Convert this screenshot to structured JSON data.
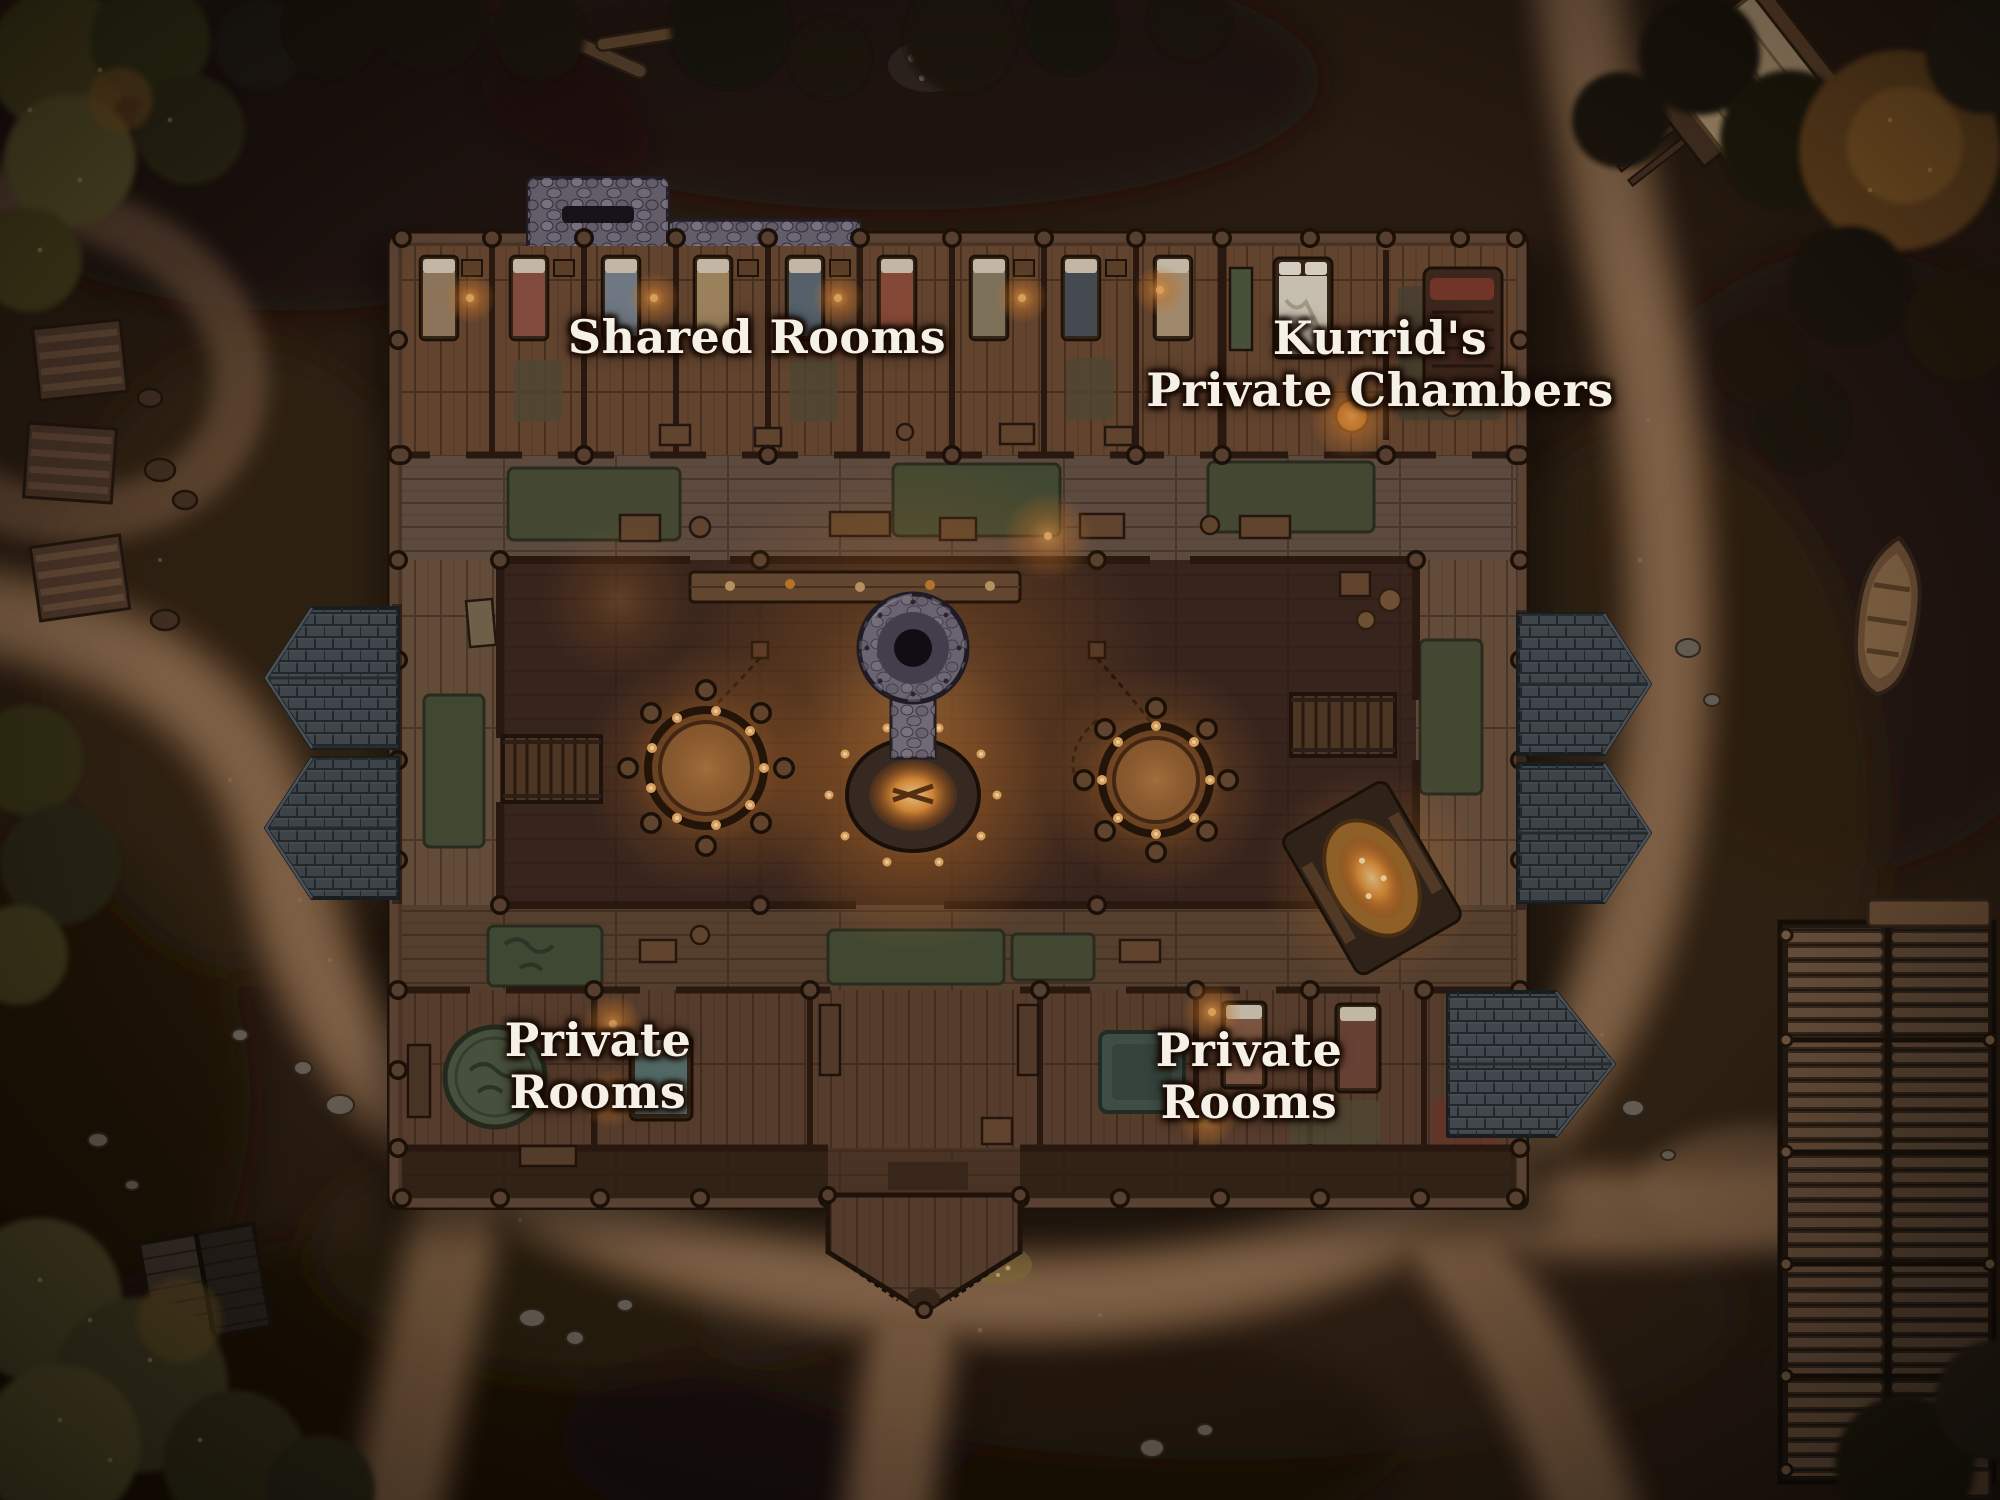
{
  "map": {
    "type": "fantasy-tavern-battle-map",
    "labels": [
      {
        "name": "shared-rooms",
        "lines": [
          "Shared Rooms"
        ],
        "x": 757,
        "y": 337
      },
      {
        "name": "kurrids-private-chambers",
        "lines": [
          "Kurrid's",
          "Private Chambers"
        ],
        "x": 1380,
        "y": 338
      },
      {
        "name": "private-rooms-left",
        "lines": [
          "Private",
          "Rooms"
        ],
        "x": 598,
        "y": 1040
      },
      {
        "name": "private-rooms-right",
        "lines": [
          "Private",
          "Rooms"
        ],
        "x": 1249,
        "y": 1050
      }
    ],
    "colors": {
      "ground": "#2b1d12",
      "dirt_path": "#8d6b4d",
      "building_wood": "#5a4030",
      "wall_dark": "#2b1a10",
      "warm_floor": "#6b4a34",
      "hall_floor": "#3c2820",
      "stone_gray": "#7d7787",
      "roof_slate": "#49525a",
      "rug_green": "#4a5038",
      "pool_green": "#4e5944",
      "fire_glow": "#e89b45",
      "label_text": "#f6f1e6",
      "foliage_olive": "#4c4526",
      "autumn_tree": "#8a5e2a"
    },
    "map_objects": [
      "tavern-building",
      "central-hearth",
      "chandelier-tables",
      "staircases",
      "green-rugs",
      "bedrooms",
      "bath-pool",
      "entrance-porch",
      "dirt-paths",
      "log-dock",
      "covered-wagon",
      "rowboat",
      "wood-pallets",
      "woodshed",
      "trees",
      "rocks"
    ]
  }
}
